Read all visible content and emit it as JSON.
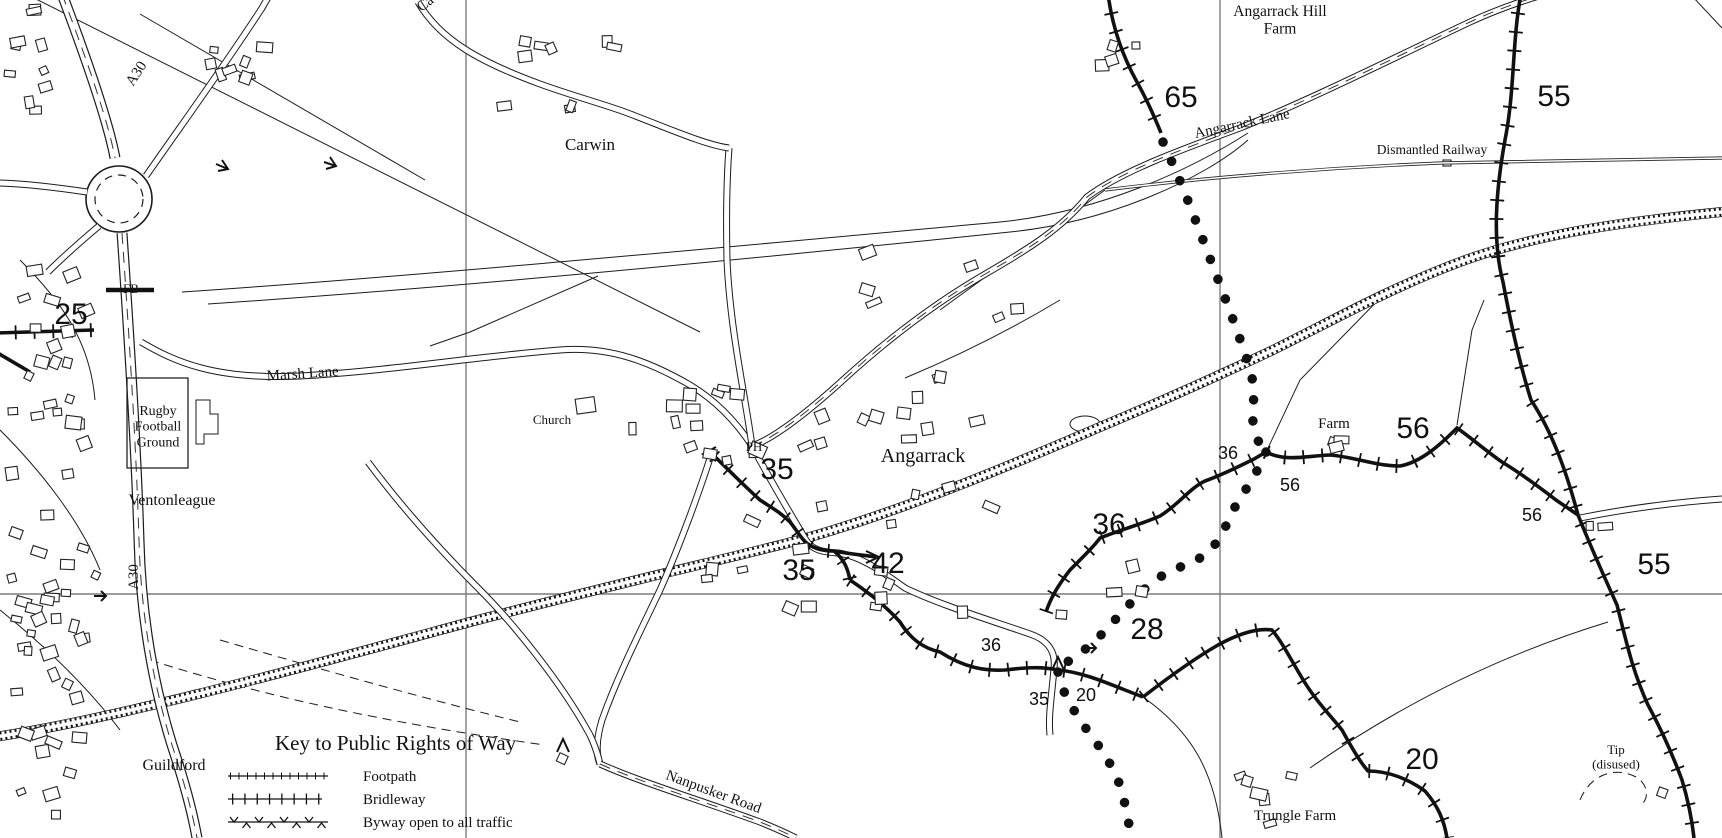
{
  "map": {
    "kind": "ordnance-survey-style-map",
    "area_name": "Angarrack",
    "colors": {
      "background": "#ffffff",
      "line": "#1b1b1b",
      "grid": "#7d7d7d",
      "text": "#111111"
    },
    "grid": {
      "vertical_x": [
        466,
        1220
      ],
      "horizontal_y": [
        594
      ]
    },
    "legend": {
      "title": "Key to Public Rights of Way",
      "items": [
        {
          "label": "Footpath",
          "symbol": "footpath-ticked-line"
        },
        {
          "label": "Bridleway",
          "symbol": "bridleway-crossed-line"
        },
        {
          "label": "Byway open to all traffic",
          "symbol": "byway-chevron-line"
        }
      ]
    },
    "labels": [
      {
        "name": "road-a30-north-label",
        "text": "A30",
        "x": 140,
        "y": 76,
        "size": 15,
        "font": "serif",
        "rot": -57
      },
      {
        "name": "road-ca-partial-label",
        "text": "Ca",
        "x": 428,
        "y": 7,
        "size": 15,
        "font": "serif",
        "rot": -38
      },
      {
        "name": "carwin-label",
        "text": "Carwin",
        "x": 590,
        "y": 150,
        "size": 17,
        "font": "serif"
      },
      {
        "name": "angarrack-hill-farm-label",
        "lines": [
          "Angarrack Hill",
          "Farm"
        ],
        "x": 1280,
        "y": 16,
        "size": 15.5,
        "font": "serif"
      },
      {
        "name": "path-number-65",
        "text": "65",
        "x": 1181,
        "y": 107,
        "size": 30,
        "font": "sans"
      },
      {
        "name": "angarrack-lane-label",
        "text": "Angarrack Lane",
        "x": 1243,
        "y": 128,
        "size": 15,
        "font": "serif",
        "rot": -12
      },
      {
        "name": "dismantled-railway-label",
        "text": "Dismantled Railway",
        "x": 1432,
        "y": 154,
        "size": 13.5,
        "font": "serif"
      },
      {
        "name": "path-number-55-top",
        "text": "55",
        "x": 1554,
        "y": 106,
        "size": 30,
        "font": "sans"
      },
      {
        "name": "footbridge-label",
        "text": "FB",
        "x": 131,
        "y": 293,
        "size": 13,
        "font": "serif"
      },
      {
        "name": "path-number-25",
        "text": "25",
        "x": 71,
        "y": 324,
        "size": 30,
        "font": "sans"
      },
      {
        "name": "marsh-lane-label",
        "text": "Marsh Lane",
        "x": 303,
        "y": 378,
        "size": 15,
        "font": "serif",
        "rot": -4
      },
      {
        "name": "rugby-football-ground-label",
        "lines": [
          "Rugby",
          "Football",
          "Ground"
        ],
        "x": 158,
        "y": 415,
        "size": 14,
        "font": "serif"
      },
      {
        "name": "ventonleague-label",
        "text": "Ventonleague",
        "x": 172,
        "y": 505,
        "size": 16,
        "font": "serif"
      },
      {
        "name": "church-label",
        "text": "Church",
        "x": 552,
        "y": 424,
        "size": 13,
        "font": "serif"
      },
      {
        "name": "public-house-label",
        "text": "PH",
        "x": 754,
        "y": 451,
        "size": 13,
        "font": "serif"
      },
      {
        "name": "path-number-35-a",
        "text": "35",
        "x": 777,
        "y": 479,
        "size": 30,
        "font": "sans"
      },
      {
        "name": "angarrack-label",
        "text": "Angarrack",
        "x": 923,
        "y": 462,
        "size": 20,
        "font": "serif"
      },
      {
        "name": "path-number-35-b",
        "text": "35",
        "x": 799,
        "y": 580,
        "size": 30,
        "font": "sans"
      },
      {
        "name": "path-number-42",
        "text": "42",
        "x": 888,
        "y": 573,
        "size": 30,
        "font": "sans"
      },
      {
        "name": "path-number-36-a",
        "text": "36",
        "x": 1109,
        "y": 534,
        "size": 30,
        "font": "sans"
      },
      {
        "name": "path-number-36-b",
        "text": "36",
        "x": 1228,
        "y": 459,
        "size": 18,
        "font": "sans"
      },
      {
        "name": "farm-label",
        "text": "Farm",
        "x": 1334,
        "y": 428,
        "size": 15,
        "font": "serif"
      },
      {
        "name": "path-number-56-a",
        "text": "56",
        "x": 1413,
        "y": 438,
        "size": 30,
        "font": "sans"
      },
      {
        "name": "path-number-56-b",
        "text": "56",
        "x": 1290,
        "y": 491,
        "size": 18,
        "font": "sans"
      },
      {
        "name": "path-number-56-c",
        "text": "56",
        "x": 1532,
        "y": 521,
        "size": 18,
        "font": "sans"
      },
      {
        "name": "path-number-55-b",
        "text": "55",
        "x": 1654,
        "y": 574,
        "size": 30,
        "font": "sans"
      },
      {
        "name": "path-number-28",
        "text": "28",
        "x": 1147,
        "y": 639,
        "size": 30,
        "font": "sans"
      },
      {
        "name": "path-number-36-c",
        "text": "36",
        "x": 991,
        "y": 651,
        "size": 18,
        "font": "sans"
      },
      {
        "name": "path-number-35-c",
        "text": "35",
        "x": 1039,
        "y": 705,
        "size": 18,
        "font": "sans"
      },
      {
        "name": "path-number-20-a",
        "text": "20",
        "x": 1086,
        "y": 701,
        "size": 18,
        "font": "sans"
      },
      {
        "name": "path-number-20-b",
        "text": "20",
        "x": 1422,
        "y": 769,
        "size": 30,
        "font": "sans"
      },
      {
        "name": "trungle-farm-label",
        "text": "Trungle Farm",
        "x": 1295,
        "y": 820,
        "size": 15,
        "font": "serif"
      },
      {
        "name": "tip-disused-label",
        "lines": [
          "Tip",
          "(disused)"
        ],
        "x": 1616,
        "y": 754,
        "size": 13,
        "font": "serif"
      },
      {
        "name": "guildford-label",
        "text": "Guildford",
        "x": 174,
        "y": 770,
        "size": 16,
        "font": "serif"
      },
      {
        "name": "road-a30-south-label",
        "text": "A30",
        "x": 138,
        "y": 577,
        "size": 15,
        "font": "serif",
        "rot": -90
      },
      {
        "name": "nanpusker-road-label",
        "text": "Nanpusker Road",
        "x": 712,
        "y": 796,
        "size": 15,
        "font": "serif",
        "rot": 20
      }
    ]
  }
}
